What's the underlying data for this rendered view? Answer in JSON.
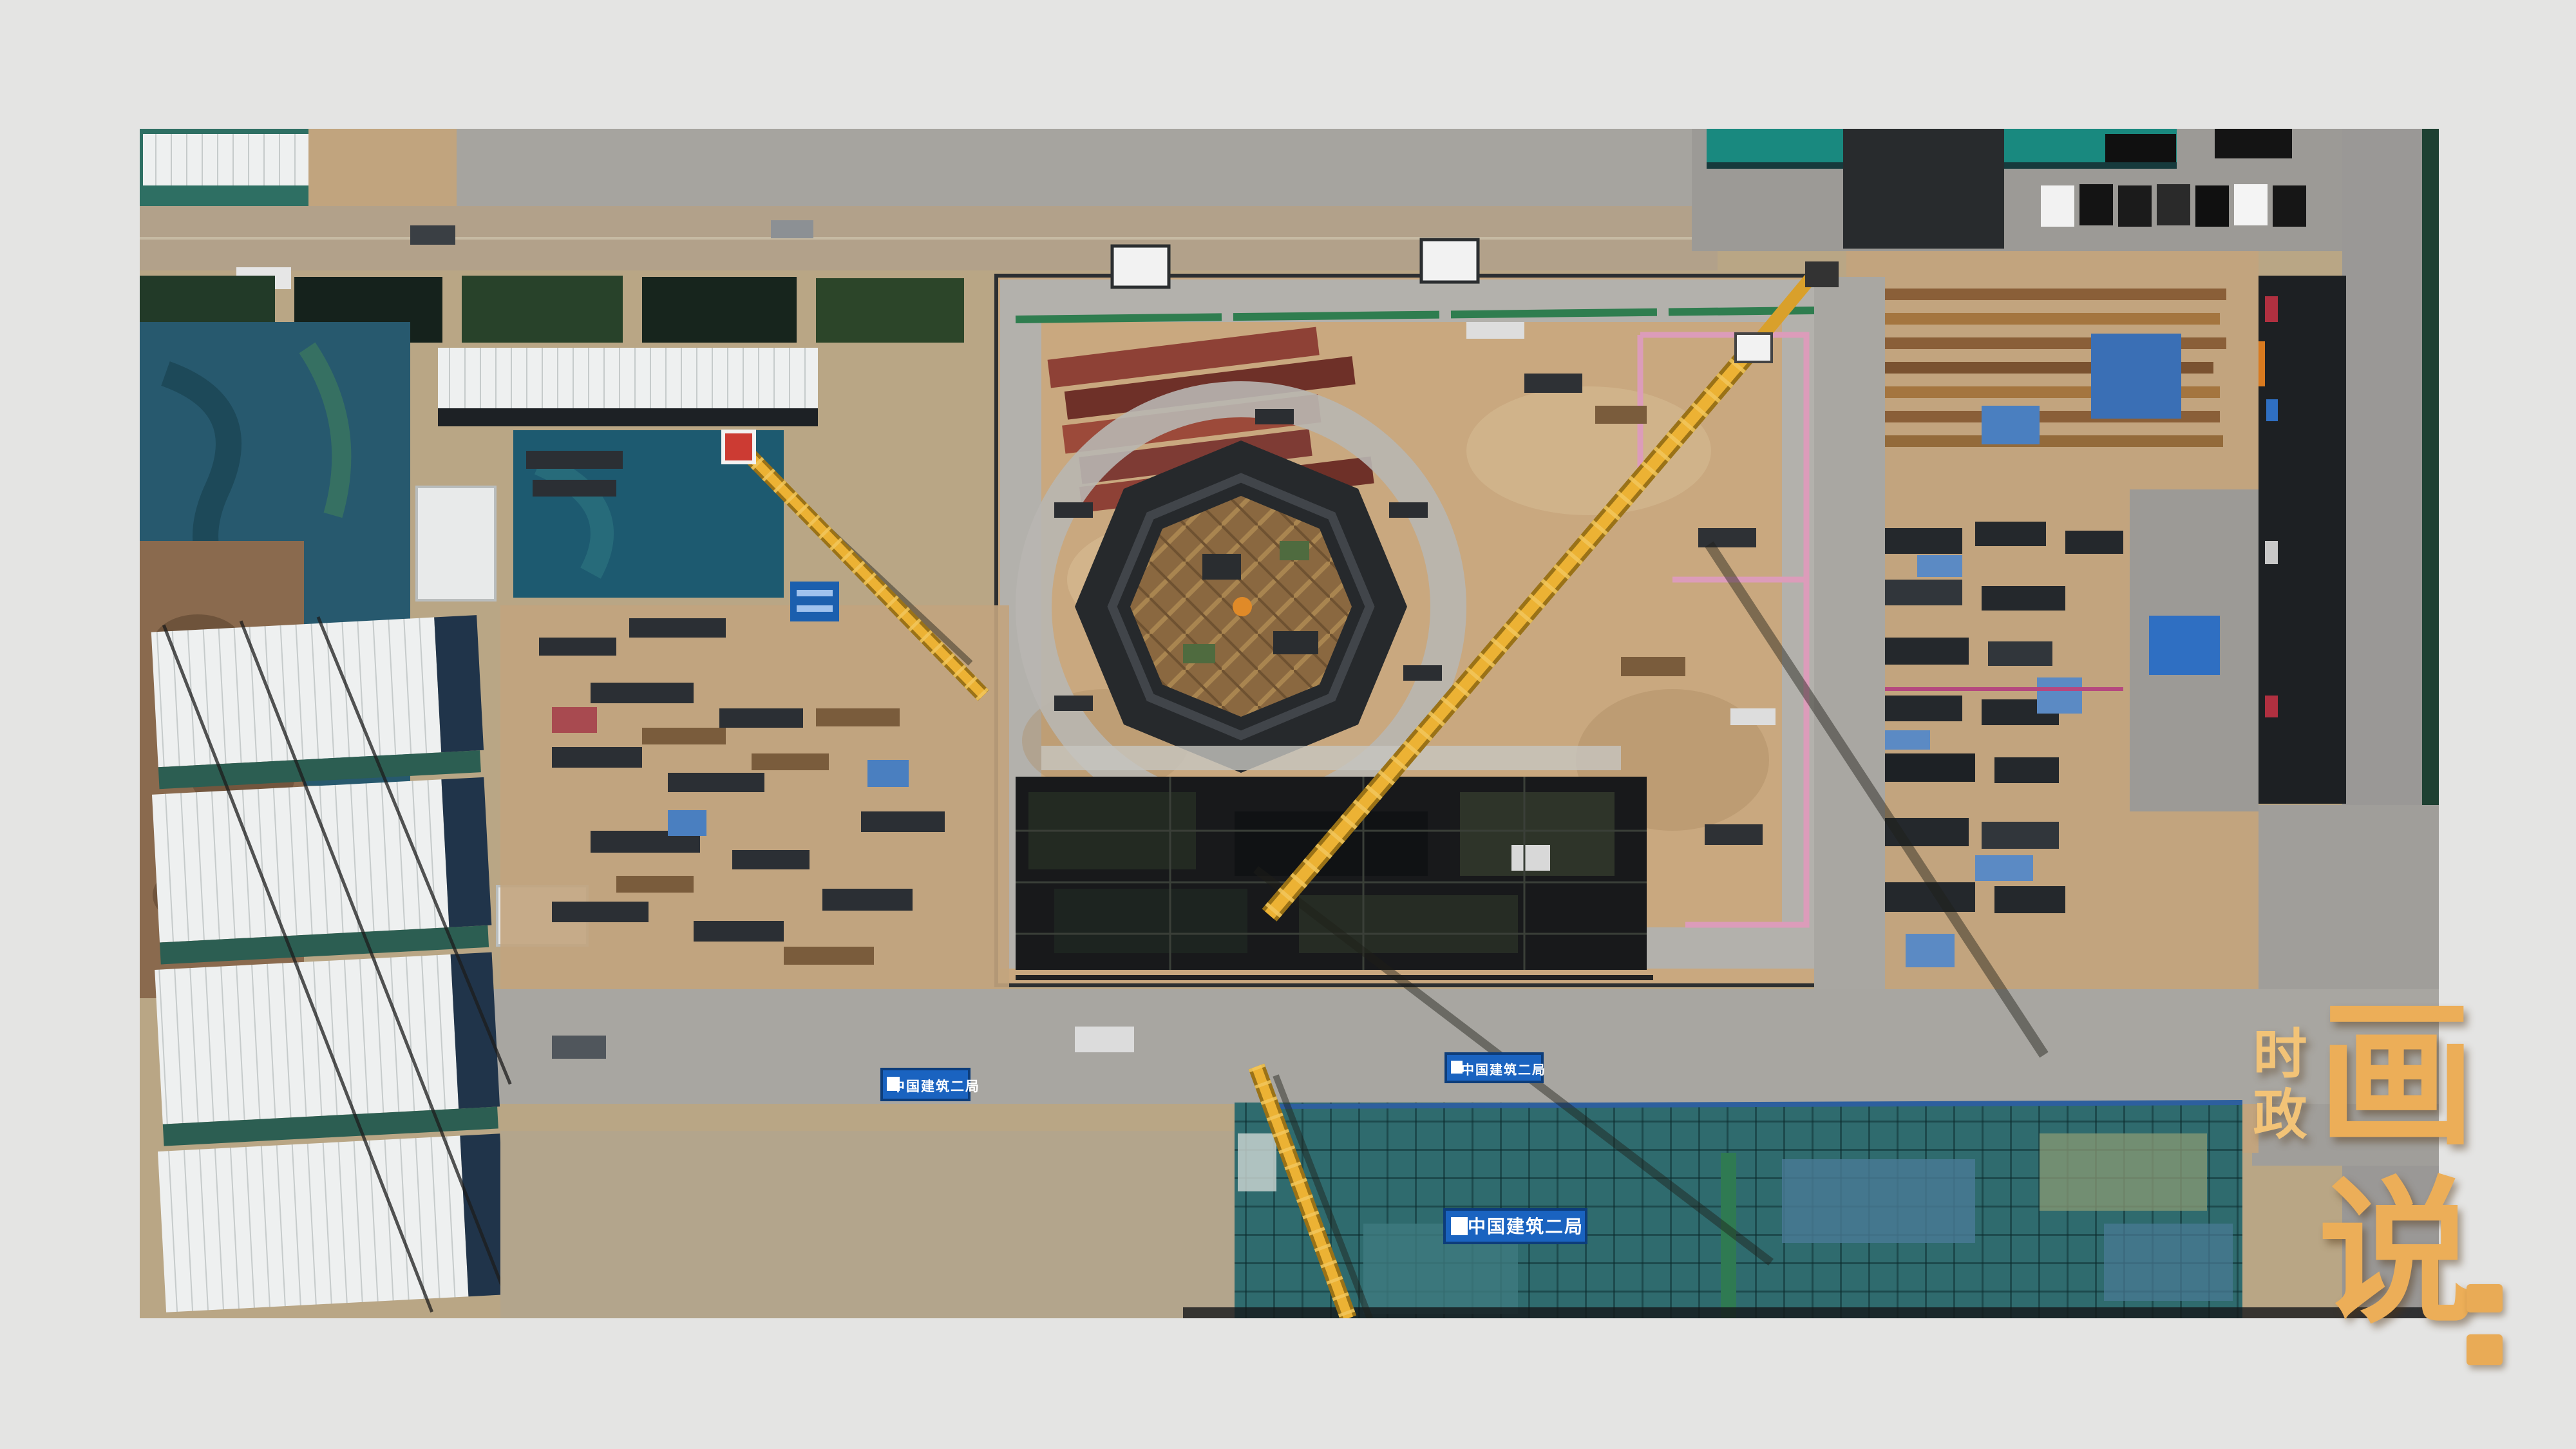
{
  "page": {
    "background_color": "#e4e4e3"
  },
  "branding": {
    "small_text": "时政",
    "large_text": "画说",
    "colon": "：",
    "gold_color": "#ecae58",
    "gold_light": "#f2c377"
  },
  "photo": {
    "subject": "aerial-construction-site",
    "banners": [
      {
        "text": "中国建筑二局"
      },
      {
        "text": "中国建筑二局"
      },
      {
        "text": "中国建筑二局"
      }
    ],
    "colors": {
      "dirt": "#c4a37a",
      "concrete": "#a8a6a1",
      "pit_dark": "#18191b",
      "octagon_dark": "#26292c",
      "timber": "#8a6840",
      "teal_net": "#2f6b6e",
      "tarp_blue": "#27596e",
      "banner_blue": "#1a63c0",
      "crane_yellow": "#ecb234",
      "pink_line": "#dc9cba",
      "red_container": "#8e4136",
      "white_roof": "#eef0f0",
      "green_dark": "#24402b",
      "bright_teal": "#19897f"
    }
  }
}
